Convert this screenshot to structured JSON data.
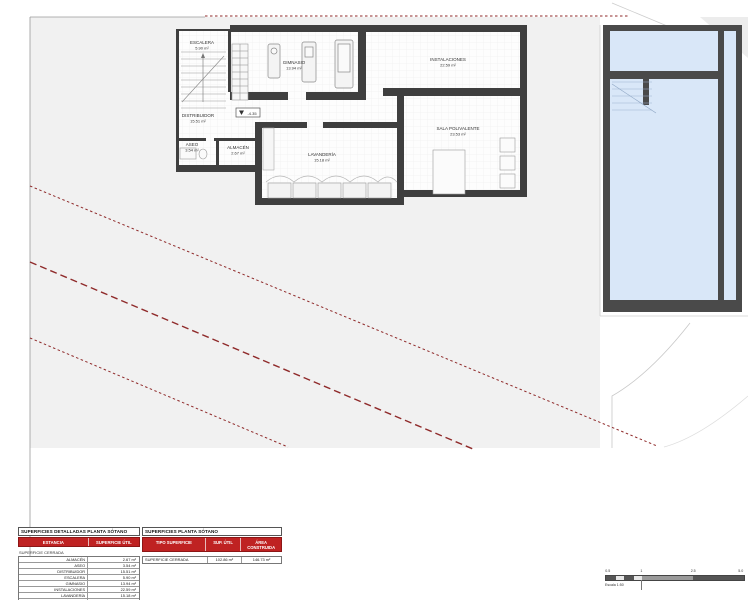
{
  "colors": {
    "accent_red": "#bf2222",
    "dashed_line_red": "#8f2a2a",
    "wall_dark": "#3f3f3f",
    "pool_blue": "#d9e7f8",
    "sheet_gray": "#f1f1f1"
  },
  "plan": {
    "rooms": [
      {
        "name": "ESCALERA",
        "area": "5.90 m²"
      },
      {
        "name": "GIMNASIO",
        "area": "13.94 m²"
      },
      {
        "name": "INSTALACIONES",
        "area": "22.59 m²"
      },
      {
        "name": "DISTRIBUIDOR",
        "area": "15.51 m²"
      },
      {
        "name": "ASEO",
        "area": "3.54 m²"
      },
      {
        "name": "ALMACÉN",
        "area": "2.67 m²"
      },
      {
        "name": "LAVANDERÍA",
        "area": "15.18 m²"
      },
      {
        "name": "SALA POLIVALENTE",
        "area": "23.53 m²"
      }
    ],
    "level_marker": "-4.35"
  },
  "tables": {
    "detailed": {
      "title": "SUPERFICIES DETALLADAS PLANTA SÓTANO",
      "col_estancia": "ESTANCIA",
      "col_superficie": "SUPERFICIE ÚTIL",
      "section": "SUPERFICIE CERRADA",
      "rows": [
        [
          "ALMACÉN",
          "2.67 m²"
        ],
        [
          "ASEO",
          "3.54 m²"
        ],
        [
          "DISTRIBUIDOR",
          "15.51 m²"
        ],
        [
          "ESCALERA",
          "5.90 m²"
        ],
        [
          "GIMNASIO",
          "13.94 m²"
        ],
        [
          "INSTALACIONES",
          "22.59 m²"
        ],
        [
          "LAVANDERÍA",
          "15.18 m²"
        ],
        [
          "SALA POLIVALENTE",
          "23.53 m²"
        ]
      ],
      "total": "102.86 m²"
    },
    "summary": {
      "title": "SUPERFICIES PLANTA SÓTANO",
      "col_tipo": "TIPO SUPERFICIE",
      "col_util": "SUP. ÚTIL",
      "col_construida": "ÁREA CONSTRUIDA",
      "row": {
        "tipo": "SUPERFICIE CERRADA",
        "util": "102.86 m²",
        "construida": "146.73 m²"
      }
    }
  },
  "scalebar": {
    "labels": [
      "0.5",
      "1",
      "2.5",
      "5.0"
    ],
    "caption": "Escala 1:50"
  }
}
